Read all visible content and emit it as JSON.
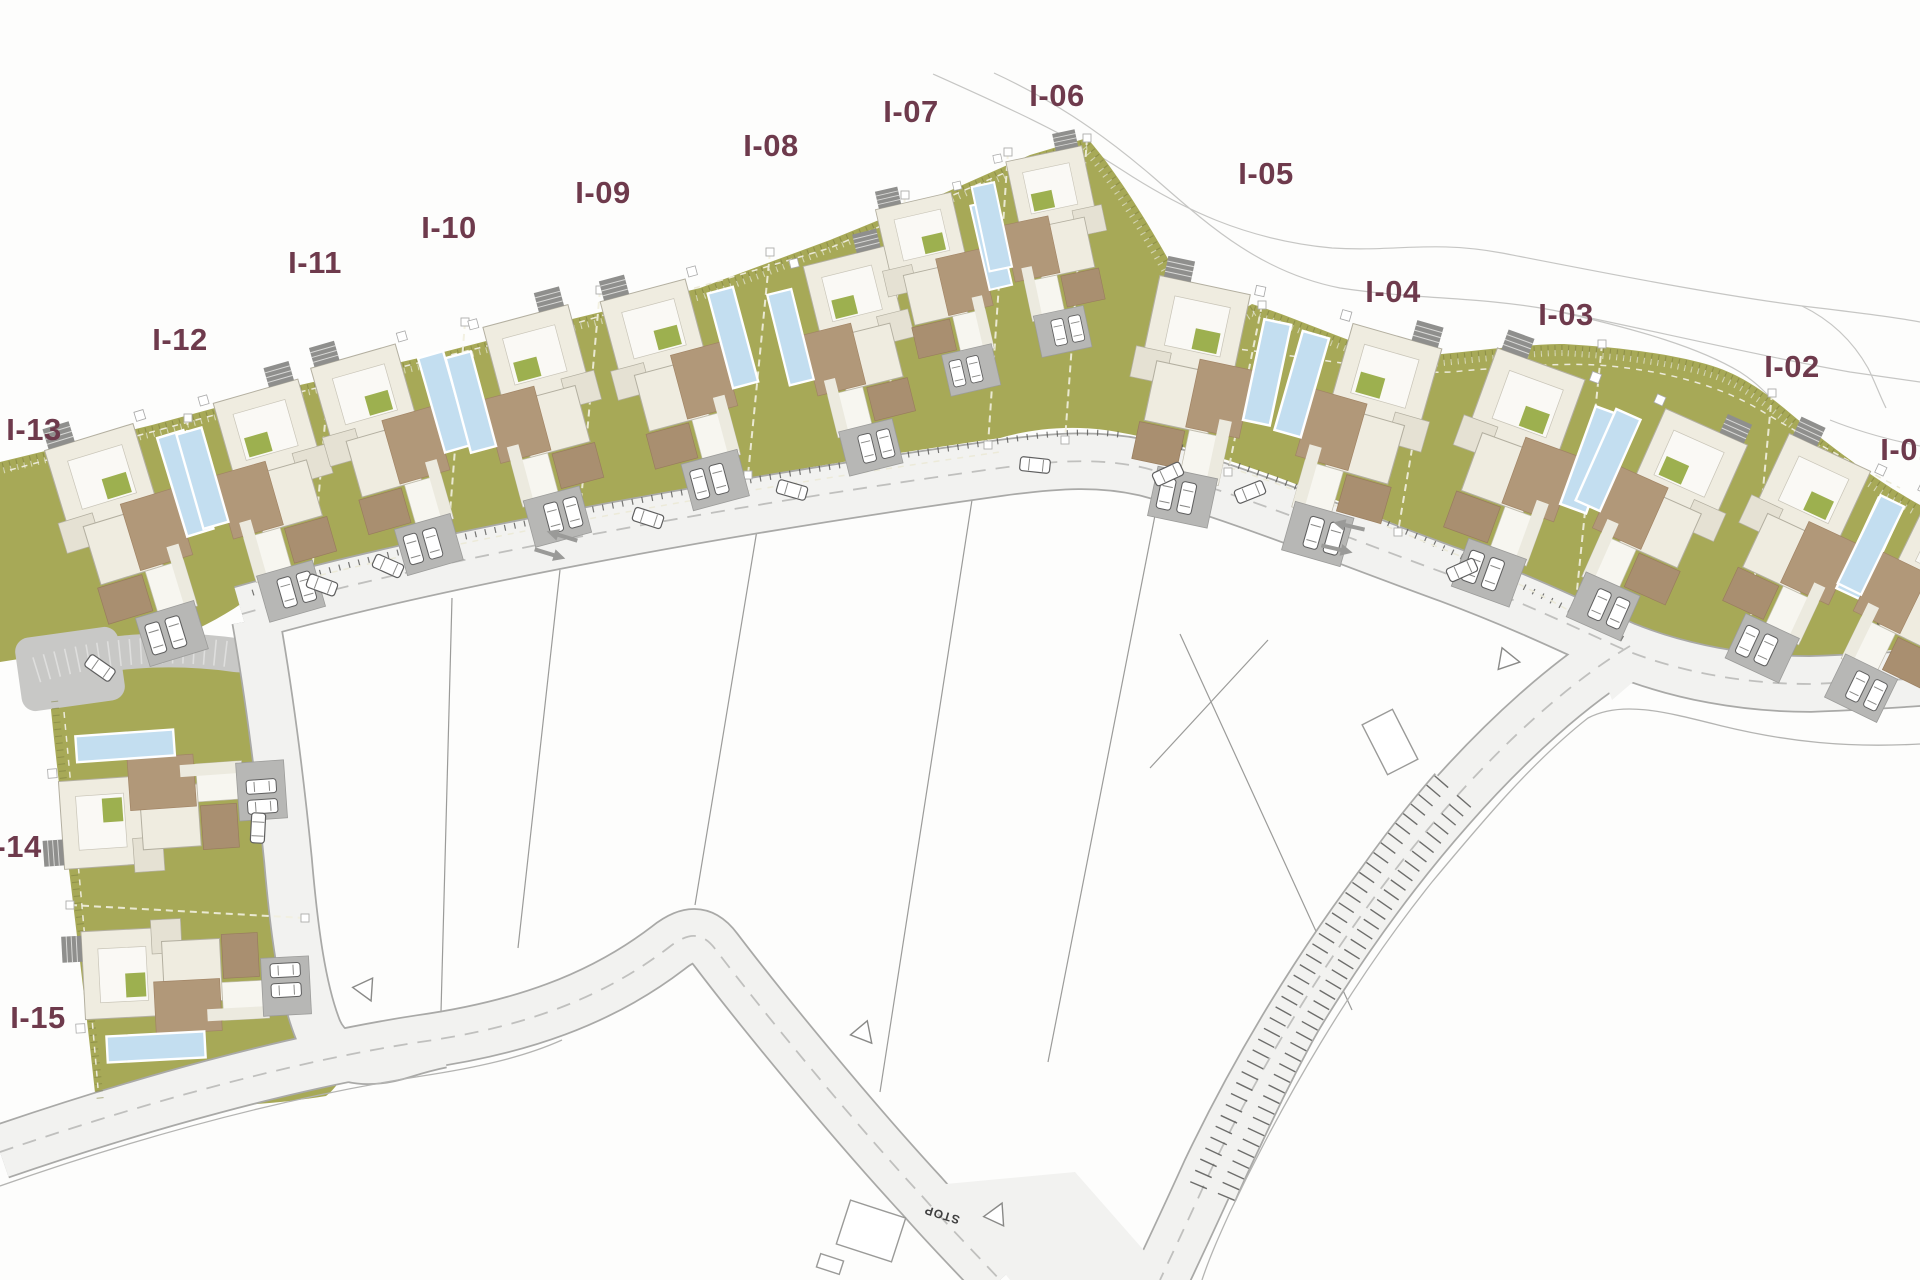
{
  "plan": {
    "region_labels": [
      {
        "id": "I-13",
        "text": "I-13",
        "x": 34,
        "y": 429
      },
      {
        "id": "I-12",
        "text": "I-12",
        "x": 180,
        "y": 339
      },
      {
        "id": "I-11",
        "text": "I-11",
        "x": 315,
        "y": 262
      },
      {
        "id": "I-10",
        "text": "I-10",
        "x": 449,
        "y": 227
      },
      {
        "id": "I-09",
        "text": "I-09",
        "x": 603,
        "y": 192
      },
      {
        "id": "I-08",
        "text": "I-08",
        "x": 771,
        "y": 145
      },
      {
        "id": "I-07",
        "text": "I-07",
        "x": 911,
        "y": 111
      },
      {
        "id": "I-06",
        "text": "I-06",
        "x": 1057,
        "y": 95
      },
      {
        "id": "I-05",
        "text": "I-05",
        "x": 1266,
        "y": 173
      },
      {
        "id": "I-04",
        "text": "I-04",
        "x": 1393,
        "y": 291
      },
      {
        "id": "I-03",
        "text": "I-03",
        "x": 1566,
        "y": 314
      },
      {
        "id": "I-02",
        "text": "I-02",
        "x": 1792,
        "y": 366
      },
      {
        "id": "I-01",
        "text": "I-01",
        "x": 1908,
        "y": 449
      },
      {
        "id": "I-14",
        "text": "I-14",
        "x": 14,
        "y": 846
      },
      {
        "id": "I-15",
        "text": "I-15",
        "x": 38,
        "y": 1017
      }
    ],
    "stop_sign": {
      "text": "STOP",
      "x": 943,
      "y": 1211,
      "rot": 197
    },
    "villas": [
      {
        "id": "I-13",
        "x": 140,
        "y": 540,
        "rot": -17,
        "v": "A",
        "s": 1.05
      },
      {
        "id": "I-12",
        "x": 268,
        "y": 500,
        "rot": -16,
        "v": "B",
        "s": 1.0
      },
      {
        "id": "I-11",
        "x": 400,
        "y": 455,
        "rot": -16,
        "v": "A",
        "s": 1.0
      },
      {
        "id": "I-10",
        "x": 536,
        "y": 425,
        "rot": -15,
        "v": "B",
        "s": 1.0
      },
      {
        "id": "I-09",
        "x": 688,
        "y": 390,
        "rot": -15,
        "v": "A",
        "s": 1.0
      },
      {
        "id": "I-08",
        "x": 852,
        "y": 360,
        "rot": -14,
        "v": "B",
        "s": 0.95
      },
      {
        "id": "I-07",
        "x": 950,
        "y": 290,
        "rot": -13,
        "v": "A",
        "s": 0.88
      },
      {
        "id": "I-06",
        "x": 1048,
        "y": 250,
        "rot": -12,
        "v": "B",
        "s": 0.88
      },
      {
        "id": "I-05",
        "x": 1200,
        "y": 400,
        "rot": 12,
        "v": "A",
        "s": 1.05
      },
      {
        "id": "I-04",
        "x": 1348,
        "y": 440,
        "rot": 16,
        "v": "B",
        "s": 1.05
      },
      {
        "id": "I-03",
        "x": 1520,
        "y": 478,
        "rot": 20,
        "v": "A",
        "s": 1.06
      },
      {
        "id": "I-02",
        "x": 1645,
        "y": 520,
        "rot": 24,
        "v": "B",
        "s": 1.02
      },
      {
        "id": "I-01",
        "x": 1800,
        "y": 560,
        "rot": 25,
        "v": "A",
        "s": 1.02
      },
      {
        "id": "I-01-east",
        "x": 1905,
        "y": 605,
        "rot": 26,
        "v": "B",
        "s": 1.0
      },
      {
        "id": "I-14",
        "x": 168,
        "y": 800,
        "rot": -94,
        "v": "A",
        "s": 1.0
      },
      {
        "id": "I-15",
        "x": 192,
        "y": 988,
        "rot": -93,
        "v": "B",
        "s": 1.0
      }
    ],
    "road_cars": [
      {
        "x": 100,
        "y": 668,
        "rot": 35
      },
      {
        "x": 322,
        "y": 585,
        "rot": 20
      },
      {
        "x": 388,
        "y": 566,
        "rot": 24
      },
      {
        "x": 648,
        "y": 518,
        "rot": 18
      },
      {
        "x": 792,
        "y": 490,
        "rot": 16
      },
      {
        "x": 1035,
        "y": 465,
        "rot": 6
      },
      {
        "x": 1168,
        "y": 474,
        "rot": -25
      },
      {
        "x": 1250,
        "y": 492,
        "rot": -22
      },
      {
        "x": 1462,
        "y": 570,
        "rot": -24
      },
      {
        "x": 258,
        "y": 828,
        "rot": 93
      }
    ],
    "arrows": [
      {
        "x": 562,
        "y": 536,
        "rot": 197
      },
      {
        "x": 550,
        "y": 554,
        "rot": 17
      },
      {
        "x": 1349,
        "y": 526,
        "rot": 193
      },
      {
        "x": 1337,
        "y": 549,
        "rot": 13
      }
    ],
    "yield_triangles": [
      {
        "x": 864,
        "y": 1034,
        "rot": 140
      },
      {
        "x": 997,
        "y": 1214,
        "rot": 25
      },
      {
        "x": 366,
        "y": 990,
        "rot": 155
      },
      {
        "x": 1508,
        "y": 660,
        "rot": 100
      }
    ],
    "misc_rects": [
      {
        "x": 871,
        "y": 1231,
        "w": 58,
        "h": 46,
        "rot": 18
      },
      {
        "x": 830,
        "y": 1264,
        "w": 24,
        "h": 14,
        "rot": 18
      },
      {
        "x": 1390,
        "y": 742,
        "w": 34,
        "h": 56,
        "rot": -27
      }
    ],
    "separators": [
      {
        "x1": 188,
        "y1": 418,
        "x2": 170,
        "y2": 640
      },
      {
        "x1": 330,
        "y1": 365,
        "x2": 310,
        "y2": 596
      },
      {
        "x1": 465,
        "y1": 322,
        "x2": 448,
        "y2": 538
      },
      {
        "x1": 600,
        "y1": 290,
        "x2": 580,
        "y2": 512
      },
      {
        "x1": 770,
        "y1": 252,
        "x2": 748,
        "y2": 475
      },
      {
        "x1": 905,
        "y1": 195,
        "x2": 885,
        "y2": 452
      },
      {
        "x1": 1008,
        "y1": 152,
        "x2": 988,
        "y2": 445
      },
      {
        "x1": 1087,
        "y1": 138,
        "x2": 1065,
        "y2": 440
      },
      {
        "x1": 1262,
        "y1": 305,
        "x2": 1228,
        "y2": 472
      },
      {
        "x1": 1428,
        "y1": 354,
        "x2": 1398,
        "y2": 532
      },
      {
        "x1": 1602,
        "y1": 344,
        "x2": 1575,
        "y2": 610
      },
      {
        "x1": 1772,
        "y1": 393,
        "x2": 1748,
        "y2": 650
      },
      {
        "x1": 70,
        "y1": 905,
        "x2": 305,
        "y2": 918
      }
    ],
    "colors": {
      "green": "#a7a957",
      "green_light": "#9db04f",
      "label": "#6e3a4c",
      "road_fill": "#f2f2f0",
      "road_casing": "#a9a9a7",
      "road_dash": "#c0c0be",
      "lane": "#c8c8c6",
      "pad": "#b7b7b5",
      "pad_dark": "#8f8f8d",
      "pool": "#c3def0",
      "deck": "#b19879",
      "deck_dark": "#a18465",
      "roof": "#efece0",
      "roof_white": "#faf9f5",
      "roof_gray": "#e5e1d3",
      "roof_edge": "#b3afa0",
      "contour": "#c6c6c4",
      "parcel": "#9b9b99",
      "car_stroke": "#5f5f5f",
      "tick_dark": "#565654",
      "serration": "#7d7f3f",
      "setback": "#ecead9",
      "stop": "#3f3f3f"
    }
  }
}
